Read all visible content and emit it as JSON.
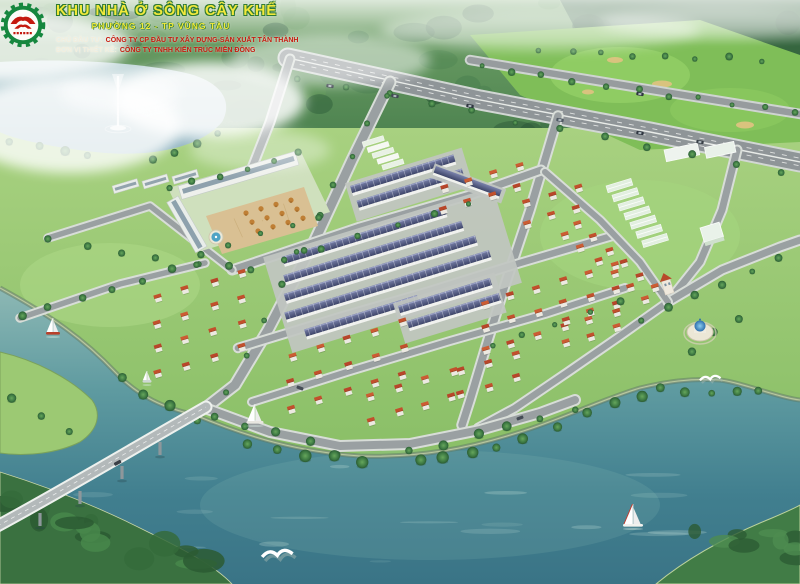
{
  "header": {
    "logo": {
      "icon": "gear-emblem-logo-icon"
    },
    "title": "KHU NHÀ Ở SÔNG CÂY KHẾ",
    "subtitle": "PHƯỜNG 12 - TP VŨNG TÀU",
    "credits": [
      {
        "label": "CHỦ ĐẦU TƯ:",
        "value": "CÔNG TY CP ĐẦU TƯ XÂY DỰNG-SẢN XUẤT TÂN THÀNH"
      },
      {
        "label": "ĐƠN VỊ THIẾT KẾ:",
        "value": "CÔNG TY TNHH KIẾN TRÚC MIỀN ĐÔNG"
      }
    ]
  },
  "icons": [
    "gear-emblem-logo-icon",
    "fountain-jet-icon",
    "sailboat-icon",
    "seagull-icon",
    "gazebo-icon",
    "bridge",
    "highway"
  ],
  "palette": {
    "title_yellow": "#f2e93b",
    "title_outline_green": "#2f7a33",
    "credit_label": "#f2eedd",
    "credit_red": "#c81a0e",
    "logo_green": "#16873f",
    "logo_red": "#c41a0e",
    "water_teal": "#4a8795",
    "lake_blue": "#9fc0cc",
    "land_green": "#95c56e",
    "roof_slate_blue": "#4a5178",
    "roof_terracotta": "#c2502c",
    "road_gray": "#9aa0a2",
    "sand_tan": "#d9c37e",
    "plaza_tan": "#d9c093",
    "fountain_blue": "#4fa3c5"
  }
}
